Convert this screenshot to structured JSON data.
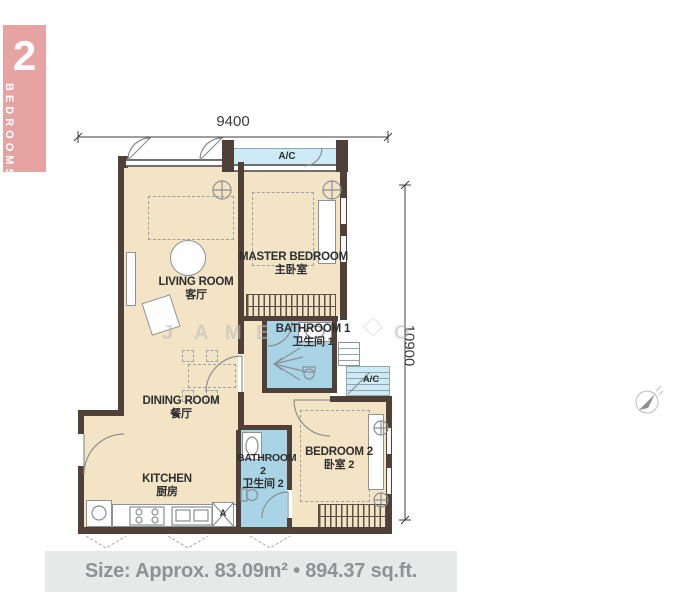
{
  "badge": {
    "count": "2",
    "label": "BEDROOMS"
  },
  "dimensions": {
    "top": "9400",
    "right": "10900"
  },
  "rooms": {
    "living": {
      "en": "LIVING ROOM",
      "cn": "客厅"
    },
    "master": {
      "en": "MASTER BEDROOM",
      "cn": "主卧室"
    },
    "bath1": {
      "en": "BATHROOM 1",
      "cn": "卫生间 1"
    },
    "dining": {
      "en": "DINING ROOM",
      "cn": "餐厅"
    },
    "kitchen": {
      "en": "KITCHEN",
      "cn": "厨房"
    },
    "bath2": {
      "en": "BATHROOM 2",
      "cn": "卫生间 2"
    },
    "bed2": {
      "en": "BEDROOM 2",
      "cn": "卧室 2"
    }
  },
  "ac": {
    "top": "A/C",
    "side": "A/C"
  },
  "markers": {
    "kitchen_a": "A"
  },
  "watermark": {
    "letters": [
      "J",
      "A",
      "M",
      "E",
      "O"
    ]
  },
  "footer": {
    "text": "Size: Approx. 83.09m² • 894.37 sq.ft."
  },
  "colors": {
    "floor": "#f3e4c6",
    "wall": "#4f4138",
    "bathroom": "#a8d4e6",
    "balcony": "#cdeaf5",
    "badge": "#e7a3a2",
    "footer_bg": "#e7e8e8",
    "footer_text": "#8f9294"
  }
}
